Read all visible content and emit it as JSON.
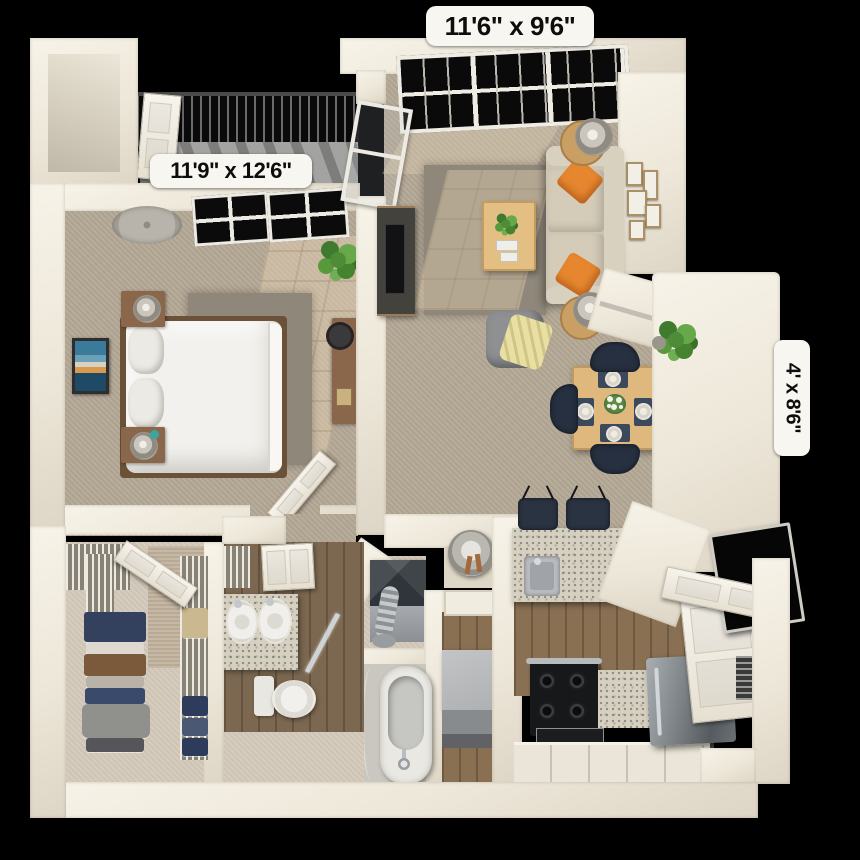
{
  "title": "3D apartment floor plan",
  "labels": {
    "living_room": "11'6\" x 9'6\"",
    "bedroom": "11'9\" x 12'6\"",
    "patio": "4' x 8'6\""
  },
  "rooms": [
    {
      "name": "living-room",
      "dimensions": "11'6\" x 9'6\""
    },
    {
      "name": "bedroom",
      "dimensions": "11'9\" x 12'6\""
    },
    {
      "name": "patio",
      "dimensions": "4' x 8'6\""
    },
    {
      "name": "dining-area"
    },
    {
      "name": "kitchen"
    },
    {
      "name": "bathroom"
    },
    {
      "name": "laundry-closet"
    },
    {
      "name": "walk-in-closet"
    },
    {
      "name": "balcony"
    }
  ],
  "furnishings": [
    "bed",
    "pillows",
    "nightstands",
    "table-lamps",
    "wall-art",
    "desk",
    "desk-chair",
    "ceiling-fan",
    "potted-plants",
    "area-rugs",
    "sofa",
    "orange-throw-pillows",
    "round-side-tables",
    "coffee-table",
    "media-console",
    "tv",
    "armchair",
    "throw-blanket",
    "gallery-frames",
    "dining-table",
    "dining-chairs",
    "place-settings",
    "flower-centerpiece",
    "bar-stools",
    "kitchen-sink",
    "range",
    "refrigerator",
    "cabinets",
    "washer",
    "dryer",
    "water-heater",
    "bathtub",
    "toilet",
    "double-vanity",
    "wire-shelving",
    "folded-clothes",
    "balcony-railing",
    "windows",
    "doors",
    "floor-mirror"
  ],
  "colors": {
    "background": "#000000",
    "wall": "#efe9dc",
    "carpet": "#b4a896",
    "rug": "#8e877a",
    "wood_floor": "#8a7053",
    "furniture_wood": "#dfb87e",
    "sofa": "#cdc4b2",
    "accent_orange": "#e6872f",
    "navy": "#2a3342",
    "granite": "#d6d0c0",
    "stainless": "#6e7478",
    "label_bg": "#f8f6f0",
    "label_text": "#0d0d0d"
  }
}
